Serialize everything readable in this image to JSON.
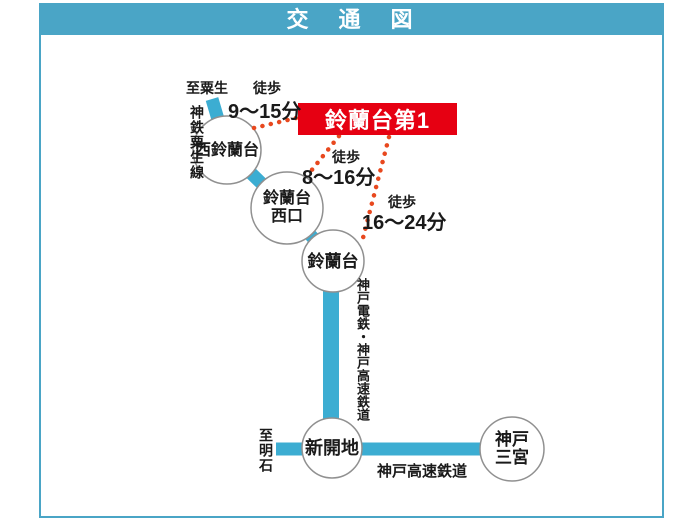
{
  "header": {
    "title": "交　通　図"
  },
  "destination": {
    "label": "鈴蘭台第1"
  },
  "stations": {
    "nishi_suzurandai": {
      "name": "西鈴蘭台"
    },
    "suzurandai_nishiguchi": {
      "line1": "鈴蘭台",
      "line2": "西口"
    },
    "suzurandai": {
      "name": "鈴蘭台"
    },
    "shinkaichi": {
      "name": "新開地"
    },
    "kobe_sannomiya": {
      "line1": "神戸",
      "line2": "三宮"
    }
  },
  "walks": {
    "from_nishi_suzurandai": {
      "prefix": "徒歩",
      "time": "9〜15分"
    },
    "from_suzurandai_nishiguchi": {
      "prefix": "徒歩",
      "time": "8〜16分"
    },
    "from_suzurandai": {
      "prefix": "徒歩",
      "time": "16〜24分"
    }
  },
  "rail_labels": {
    "to_ao": "至粟生",
    "shintetsu_ao_line": "神鉄粟生線",
    "kobe_dentetsu_kosoku": "神戸電鉄・神戸高速鉄道",
    "to_akashi": "至明石",
    "kobe_kosoku": "神戸高速鉄道"
  },
  "colors": {
    "header_bg": "#4aa5c6",
    "rail_line": "#3cadd2",
    "destination_bg": "#e60012",
    "dotted_route": "#e8481e",
    "station_circle_border": "#909090"
  }
}
